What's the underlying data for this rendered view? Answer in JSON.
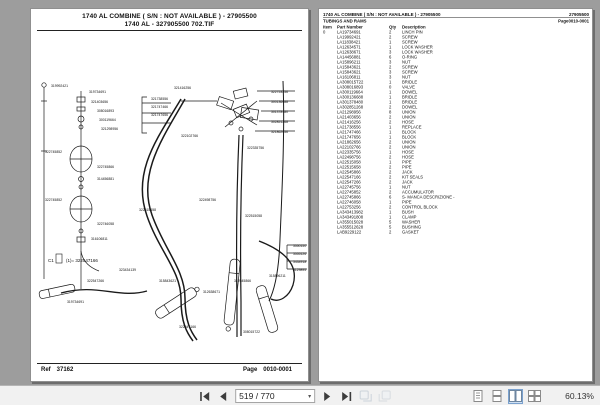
{
  "left_page": {
    "header_line1": "1740 AL   COMBINE  ( S/N :    NOT AVAILABLE ) - 27905500",
    "header_line2": "1740 AL - 327905500 702.TIF",
    "footer": {
      "ref_label": "Ref",
      "ref_value": "37162",
      "page_label": "Page",
      "page_value": "0010-0001"
    },
    "diagram": {
      "legend_note": "(1)= 322547166",
      "legend_prefix": "C1",
      "labels": [
        {
          "t": "319992421",
          "x": 20,
          "y": 46
        },
        {
          "t": "319734691",
          "x": 58,
          "y": 52
        },
        {
          "t": "321403656",
          "x": 60,
          "y": 62
        },
        {
          "t": "308016893",
          "x": 66,
          "y": 71
        },
        {
          "t": "300119664",
          "x": 68,
          "y": 80
        },
        {
          "t": "321298956",
          "x": 70,
          "y": 89
        },
        {
          "t": "321738556",
          "x": 120,
          "y": 59
        },
        {
          "t": "321747466",
          "x": 120,
          "y": 67
        },
        {
          "t": "321747656",
          "x": 120,
          "y": 75
        },
        {
          "t": "321416256",
          "x": 143,
          "y": 48
        },
        {
          "t": "322753256",
          "x": 240,
          "y": 52
        },
        {
          "t": "300136688",
          "x": 240,
          "y": 62
        },
        {
          "t": "301378480",
          "x": 240,
          "y": 72
        },
        {
          "t": "302851268",
          "x": 240,
          "y": 82
        },
        {
          "t": "321862656",
          "x": 240,
          "y": 92
        },
        {
          "t": "322102766",
          "x": 150,
          "y": 96
        },
        {
          "t": "322335756",
          "x": 216,
          "y": 108
        },
        {
          "t": "322745852",
          "x": 14,
          "y": 112
        },
        {
          "t": "322745866",
          "x": 66,
          "y": 127
        },
        {
          "t": "314456881",
          "x": 66,
          "y": 139
        },
        {
          "t": "322745852",
          "x": 14,
          "y": 160
        },
        {
          "t": "322746058",
          "x": 66,
          "y": 184
        },
        {
          "t": "316106811",
          "x": 60,
          "y": 199
        },
        {
          "t": "322515658",
          "x": 108,
          "y": 170
        },
        {
          "t": "322515058",
          "x": 214,
          "y": 176
        },
        {
          "t": "322498756",
          "x": 168,
          "y": 160
        },
        {
          "t": "323434139",
          "x": 88,
          "y": 230
        },
        {
          "t": "322547266",
          "x": 56,
          "y": 241
        },
        {
          "t": "315843621",
          "x": 128,
          "y": 241
        },
        {
          "t": "312638671",
          "x": 172,
          "y": 252
        },
        {
          "t": "322545866",
          "x": 203,
          "y": 241
        },
        {
          "t": "315896211",
          "x": 238,
          "y": 236
        },
        {
          "t": "3550150",
          "x": 262,
          "y": 206
        },
        {
          "t": "3555126",
          "x": 262,
          "y": 214
        },
        {
          "t": "3434918",
          "x": 262,
          "y": 222
        },
        {
          "t": "3129895",
          "x": 262,
          "y": 230
        },
        {
          "t": "322547166",
          "x": 148,
          "y": 287
        },
        {
          "t": "308015722",
          "x": 212,
          "y": 292
        },
        {
          "t": "319734691",
          "x": 36,
          "y": 262
        }
      ]
    }
  },
  "right_page": {
    "header_left": "1740 AL   COMBINE  ( S/N :   NOT AVAILABLE ) - 27905500",
    "header_right": "27905500",
    "subheader_left": "TUBINGS AND RAMS",
    "subheader_right": "Page0010-0001",
    "table": {
      "columns": [
        "Item",
        "Part Number",
        "Qty",
        "Description"
      ],
      "rows": [
        [
          "0",
          "LA19734691",
          "2",
          "LINCH PIN"
        ],
        [
          "",
          "LA19992421",
          "2",
          "SCREW"
        ],
        [
          "",
          "LA11838421",
          "1",
          "SCREW"
        ],
        [
          "",
          "LA12634571",
          "1",
          "LOCK WASHER"
        ],
        [
          "",
          "LA12638671",
          "3",
          "LOCK WASHER"
        ],
        [
          "",
          "LA14456881",
          "6",
          "O-RING"
        ],
        [
          "",
          "LA15896211",
          "3",
          "NUT"
        ],
        [
          "",
          "LA15843621",
          "2",
          "SCREW"
        ],
        [
          "",
          "LA15843621",
          "3",
          "SCREW"
        ],
        [
          "",
          "LA16106811",
          "3",
          "NUT"
        ],
        [
          "",
          "LA308015T22",
          "1",
          "BRIDLE"
        ],
        [
          "",
          "LA308016893",
          "0",
          "VALVE"
        ],
        [
          "",
          "LA300119664",
          "1",
          "DOWEL"
        ],
        [
          "",
          "LA300136688",
          "1",
          "BRIDLE"
        ],
        [
          "",
          "LA301378480",
          "1",
          "BRIDLE"
        ],
        [
          "",
          "LA302851268",
          "2",
          "DOWEL"
        ],
        [
          "",
          "LA21298956",
          "8",
          "UNION"
        ],
        [
          "",
          "LA21403656",
          "2",
          "UNION"
        ],
        [
          "",
          "LA21416256",
          "2",
          "HOSE"
        ],
        [
          "",
          "LA21738556",
          "1",
          "REPLACE"
        ],
        [
          "",
          "LA21747466",
          "1",
          "BLOCK"
        ],
        [
          "",
          "LA21747656",
          "1",
          "BLOCK"
        ],
        [
          "",
          "LA21862656",
          "2",
          "UNION"
        ],
        [
          "",
          "LA22102766",
          "2",
          "UNION"
        ],
        [
          "",
          "LA22335756",
          "1",
          "HOSE"
        ],
        [
          "",
          "LA22498756",
          "2",
          "HOSE"
        ],
        [
          "",
          "LA22515058",
          "1",
          "PIPE"
        ],
        [
          "",
          "LA22515658",
          "2",
          "PIPE"
        ],
        [
          "",
          "LA22545866",
          "2",
          "JACK"
        ],
        [
          "",
          "LA22547166",
          "2",
          "KIT SEALS"
        ],
        [
          "",
          "LA22547266",
          "2",
          "JACK"
        ],
        [
          "",
          "LA22745756",
          "1",
          "NUT"
        ],
        [
          "",
          "LA22745852",
          "2",
          "ACCUMULATOR"
        ],
        [
          "",
          "LA22745866",
          "6",
          "S- MANCA DESCRIZIONE -"
        ],
        [
          "",
          "LA22746058",
          "1",
          "PIPE"
        ],
        [
          "",
          "LA22753256",
          "2",
          "CONTROL BLOCK"
        ],
        [
          "",
          "LA343413982",
          "1",
          "BUSH"
        ],
        [
          "",
          "LA343491808",
          "1",
          "CLAMP"
        ],
        [
          "",
          "LA355015028",
          "5",
          "WASHER"
        ],
        [
          "",
          "LA355512628",
          "5",
          "BUSHING"
        ],
        [
          "",
          "LAB9229122",
          "2",
          "GASKET"
        ]
      ]
    }
  },
  "toolbar": {
    "page_field": "519 / 770",
    "zoom_level": "60.13%",
    "icons": [
      "first-page",
      "prev-page",
      "next-page",
      "last-page",
      "prev-view",
      "next-view",
      "single-page-view",
      "continuous-view",
      "facing-view",
      "continuous-facing-view"
    ]
  }
}
